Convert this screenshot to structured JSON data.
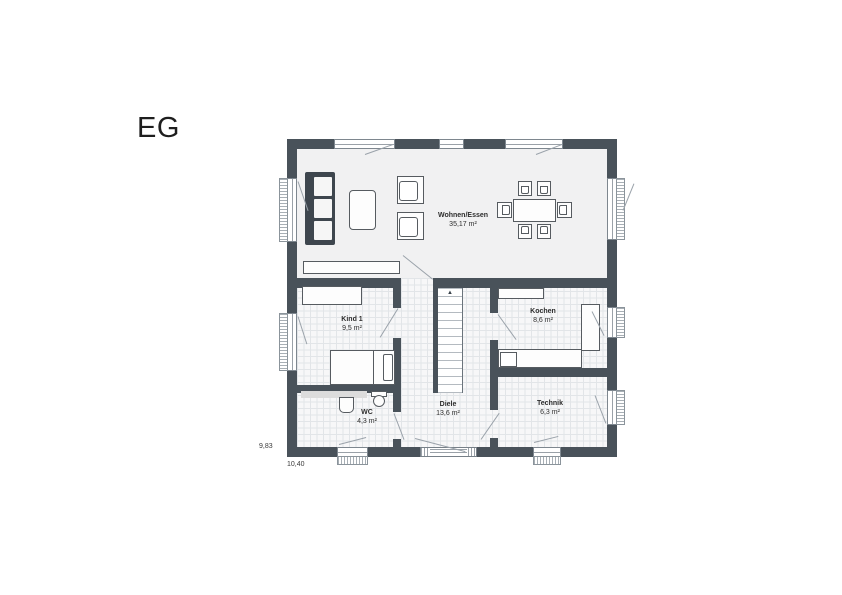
{
  "title": "EG",
  "dimensions": {
    "width_label": "10,40",
    "height_label": "9,83"
  },
  "rooms": {
    "wohnen": {
      "name": "Wohnen/Essen",
      "area": "35,17 m²"
    },
    "kind": {
      "name": "Kind 1",
      "area": "9,5 m²"
    },
    "kochen": {
      "name": "Kochen",
      "area": "8,6 m²"
    },
    "wc": {
      "name": "WC",
      "area": "4,3 m²"
    },
    "diele": {
      "name": "Diele",
      "area": "13,6 m²"
    },
    "technik": {
      "name": "Technik",
      "area": "6,3 m²"
    }
  },
  "icons": {
    "stairs_direction_icon": "▲"
  },
  "colors": {
    "wall": "#49525a",
    "floor_living": "#f1f1f2",
    "floor_tile": "#f7f7f8",
    "tile_line": "#e2e5e8",
    "furniture_line": "#565b60",
    "swing_line": "#9aa2aa",
    "sofa": "#3e464e",
    "text": "#2d2d2d"
  }
}
